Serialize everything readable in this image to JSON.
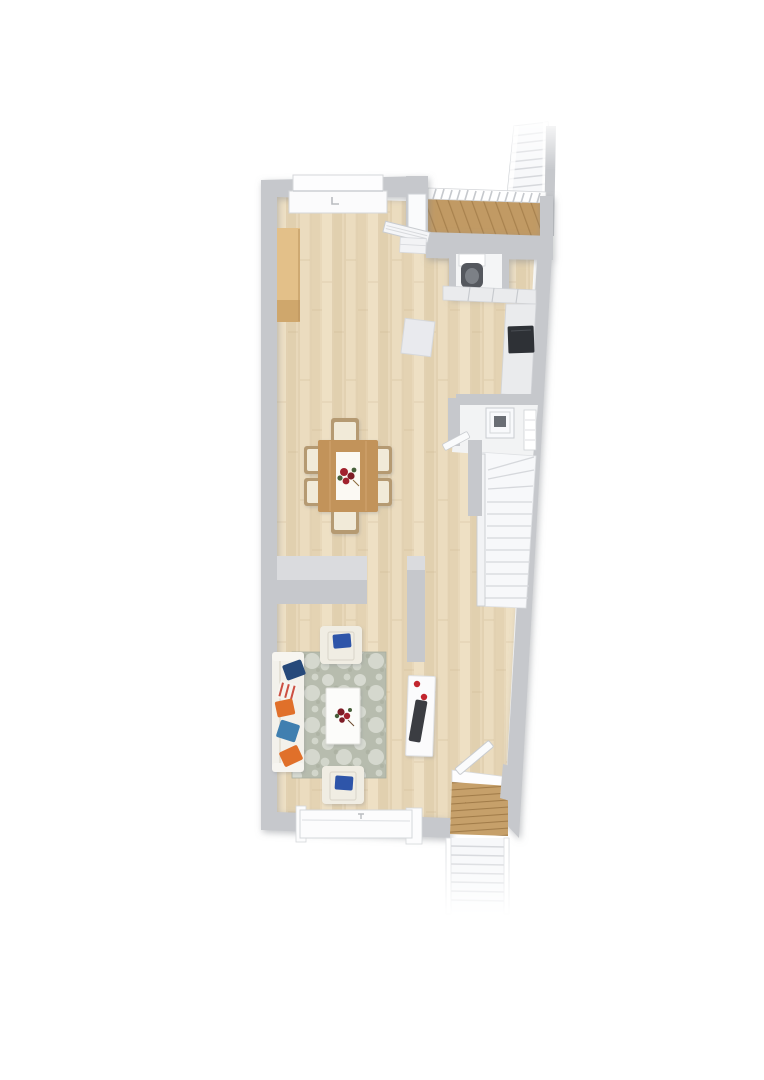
{
  "scene": {
    "type": "floor-plan-3d-top-view",
    "rooms": [
      "entry-deck",
      "wc-niche",
      "kitchenette",
      "dining-area",
      "stair-landing",
      "interior-staircase",
      "living-room",
      "hallway",
      "rear-exit"
    ],
    "furniture": [
      "upper-exterior-staircase",
      "entry-deck-railing",
      "entry-door",
      "entry-guard-railing",
      "wc-toilet",
      "kitchen-counter",
      "cooktop",
      "side-counter",
      "storage-box",
      "dining-table",
      "table-runner",
      "flower-centerpiece",
      "dining-chairs-x6",
      "laundry-basin",
      "radiator",
      "landing-door",
      "winder-staircase",
      "stair-guard-rail",
      "area-rug",
      "sofa",
      "sofa-pillows-x5",
      "armchair-north",
      "armchair-south",
      "coffee-table",
      "coffee-table-flowers",
      "tv-stand",
      "tv",
      "red-decor",
      "rear-window",
      "front-window",
      "rear-exit-door",
      "wooden-steps",
      "lower-exterior-staircase"
    ]
  },
  "colors": {
    "page_bg": "#ffffff",
    "wall": "#c6c8cc",
    "wall_top": "#dadbde",
    "wall_edge": "#aeb1b6",
    "floor_base": "#e8d8ba",
    "floor_light": "#f2e6cc",
    "floor_dark": "#d7c39e",
    "floor_gap": "#c9b48d",
    "deck_wood": "#c19a64",
    "deck_wood_dark": "#a8824e",
    "step_wood": "#c6a06a",
    "step_wood_dark": "#a17c49",
    "stair_white": "#f7f8fa",
    "stair_tread": "#d6d8dc",
    "stair_edge": "#c9ccd0",
    "counter_top": "#eaebed",
    "counter_line": "#c6c9cd",
    "wood_counter": "#e3c089",
    "wood_counter_dark": "#cfa76c",
    "table_wood": "#c2935a",
    "table_edge": "#ddb37d",
    "chair_frame": "#b59a72",
    "chair_seat": "#f1ead8",
    "runner": "#fbf9f3",
    "flower_red": "#a1242f",
    "flower_red_dark": "#7e1b26",
    "flower_green": "#47603b",
    "rug_base": "#b7bcae",
    "rug_motif": "#edefe8",
    "rug_dark": "#9aa08f",
    "sofa_body": "#f3f1eb",
    "sofa_line": "#dcd7c9",
    "pillow_navy": "#27497a",
    "pillow_orange": "#e06f2c",
    "pillow_steel": "#3f7fb0",
    "pillow_stripe": "#cc4f42",
    "armchair_body": "#f0ede3",
    "armchair_pillow": "#2f55a9",
    "coffee_table": "#fcfcfa",
    "tv_stand": "#fbfbfc",
    "tv_screen": "#3a3d42",
    "tv_red": "#c2272d",
    "fixture_dark": "#55585e",
    "cooktop": "#2e3136",
    "basin": "#f8f9fb",
    "door_white": "#fafbfc",
    "room_floor": "#f2f3f4"
  }
}
